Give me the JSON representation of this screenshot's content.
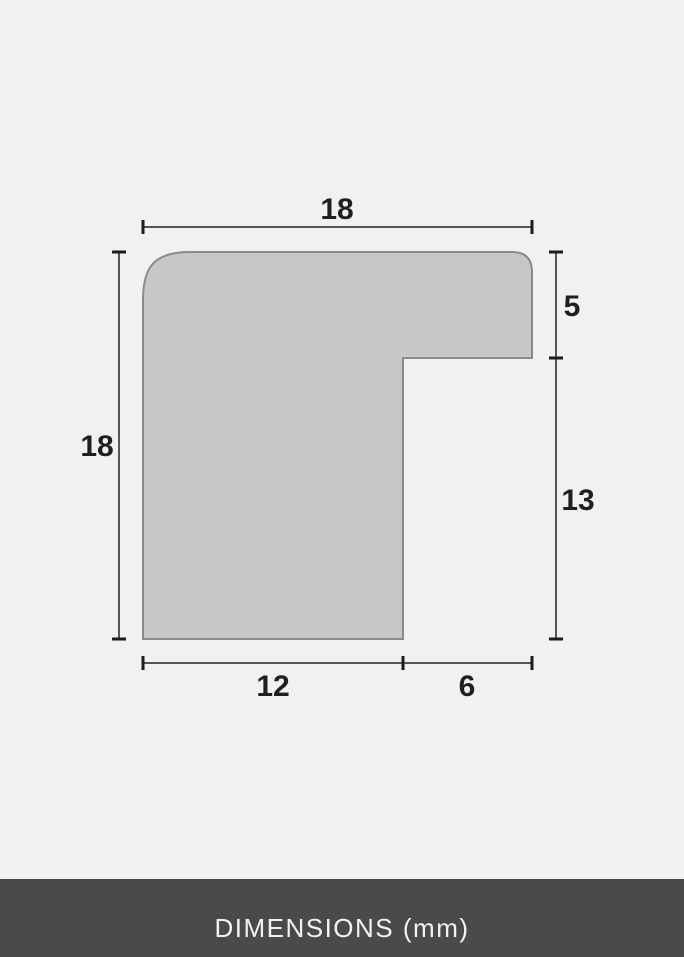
{
  "profile_diagram": {
    "shape": "picture-frame-moulding-cross-section",
    "unit": "mm",
    "dims": {
      "top_width": "18",
      "left_height": "18",
      "right_upper": "5",
      "right_lower": "13",
      "bottom_left": "12",
      "bottom_right": "6"
    },
    "colors": {
      "background": "#f1f1f0",
      "profile_fill": "#c7c7c6",
      "profile_stroke": "#8b8b8a",
      "dimension_line": "#55555a",
      "tick": "#1c1c1c",
      "label_text": "#1f1f1f",
      "footer_background": "#4a4a49",
      "footer_text": "#f2f2f1"
    }
  },
  "footer": {
    "label": "DIMENSIONS (mm)"
  }
}
